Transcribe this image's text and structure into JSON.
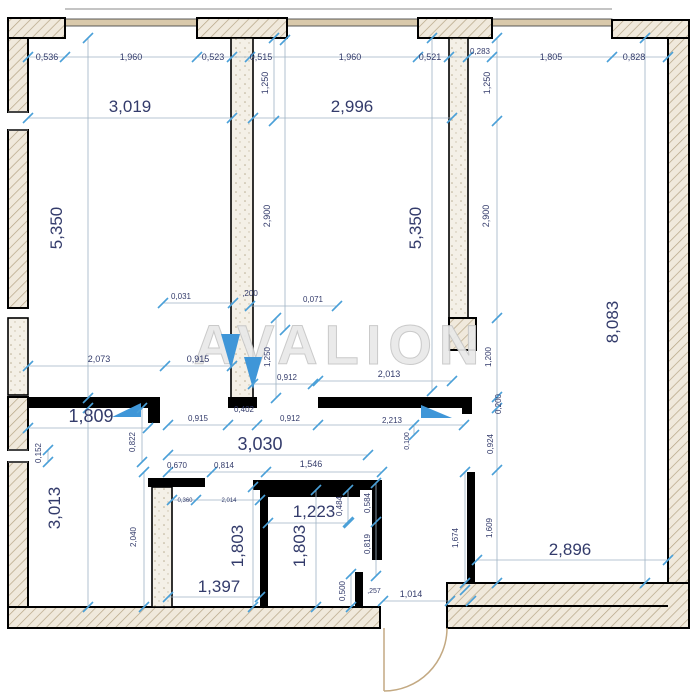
{
  "watermark": {
    "text": "AVALION"
  },
  "colors": {
    "wall": "#000000",
    "dimension_text": "#333b6b",
    "dimension_line": "#9fb3c4",
    "tick": "#4aa0d8",
    "door_swing_marker": "#3f96d8",
    "door_arc": "#c3a982",
    "watermark": "#e9e9e9",
    "window_band": "#d9c9ab",
    "hatch_fill": "#f0e9dc",
    "hatch_line": "#b5a484"
  },
  "dimensions": [
    {
      "t": "0,536",
      "x": 47,
      "y": 60,
      "r": 0,
      "s": 9
    },
    {
      "t": "1,960",
      "x": 131,
      "y": 60,
      "r": 0,
      "s": 9
    },
    {
      "t": "0,523",
      "x": 213,
      "y": 60,
      "r": 0,
      "s": 9
    },
    {
      "t": "0,515",
      "x": 261,
      "y": 60,
      "r": 0,
      "s": 9
    },
    {
      "t": "1,960",
      "x": 350,
      "y": 60,
      "r": 0,
      "s": 9
    },
    {
      "t": "0,521",
      "x": 430,
      "y": 60,
      "r": 0,
      "s": 9
    },
    {
      "t": "0,283",
      "x": 480,
      "y": 54,
      "r": 0,
      "s": 8
    },
    {
      "t": "1,805",
      "x": 551,
      "y": 60,
      "r": 0,
      "s": 9
    },
    {
      "t": "0,828",
      "x": 634,
      "y": 60,
      "r": 0,
      "s": 9
    },
    {
      "t": "3,019",
      "x": 130,
      "y": 112,
      "r": 0,
      "s": 17
    },
    {
      "t": "2,996",
      "x": 352,
      "y": 112,
      "r": 0,
      "s": 17
    },
    {
      "t": "1,250",
      "x": 268,
      "y": 83,
      "r": -90,
      "s": 9
    },
    {
      "t": "1,250",
      "x": 490,
      "y": 83,
      "r": -90,
      "s": 9
    },
    {
      "t": "5,350",
      "x": 62,
      "y": 228,
      "r": -90,
      "s": 17
    },
    {
      "t": "2,900",
      "x": 270,
      "y": 216,
      "r": -90,
      "s": 9
    },
    {
      "t": "5,350",
      "x": 421,
      "y": 228,
      "r": -90,
      "s": 17
    },
    {
      "t": "2,900",
      "x": 489,
      "y": 216,
      "r": -90,
      "s": 9
    },
    {
      "t": "8,083",
      "x": 618,
      "y": 322,
      "r": -90,
      "s": 17
    },
    {
      "t": "0,031",
      "x": 181,
      "y": 299,
      "r": 0,
      "s": 8
    },
    {
      "t": ",200",
      "x": 250,
      "y": 296,
      "r": 0,
      "s": 8
    },
    {
      "t": "0,071",
      "x": 313,
      "y": 302,
      "r": 0,
      "s": 8
    },
    {
      "t": "2,073",
      "x": 99,
      "y": 362,
      "r": 0,
      "s": 9
    },
    {
      "t": "0,915",
      "x": 198,
      "y": 362,
      "r": 0,
      "s": 9
    },
    {
      "t": "1,250",
      "x": 270,
      "y": 357,
      "r": -90,
      "s": 8
    },
    {
      "t": "0,912",
      "x": 287,
      "y": 380,
      "r": 0,
      "s": 8
    },
    {
      "t": "2,013",
      "x": 389,
      "y": 377,
      "r": 0,
      "s": 9
    },
    {
      "t": "1,200",
      "x": 491,
      "y": 357,
      "r": -90,
      "s": 8
    },
    {
      "t": "1,809",
      "x": 91,
      "y": 422,
      "r": 0,
      "s": 18
    },
    {
      "t": "0,915",
      "x": 198,
      "y": 421,
      "r": 0,
      "s": 8
    },
    {
      "t": "0,912",
      "x": 290,
      "y": 421,
      "r": 0,
      "s": 8
    },
    {
      "t": "0,402",
      "x": 244,
      "y": 412,
      "r": 0,
      "s": 8
    },
    {
      "t": "2,213",
      "x": 392,
      "y": 423,
      "r": 0,
      "s": 8
    },
    {
      "t": "0,100",
      "x": 409,
      "y": 441,
      "r": -90,
      "s": 7
    },
    {
      "t": "0,200",
      "x": 501,
      "y": 404,
      "r": -90,
      "s": 8
    },
    {
      "t": "0,924",
      "x": 493,
      "y": 444,
      "r": -90,
      "s": 8
    },
    {
      "t": "0,152",
      "x": 41,
      "y": 453,
      "r": -90,
      "s": 8
    },
    {
      "t": "0,822",
      "x": 135,
      "y": 442,
      "r": -90,
      "s": 8
    },
    {
      "t": "3,030",
      "x": 260,
      "y": 450,
      "r": 0,
      "s": 18
    },
    {
      "t": "0,670",
      "x": 177,
      "y": 468,
      "r": 0,
      "s": 8
    },
    {
      "t": "0,814",
      "x": 224,
      "y": 468,
      "r": 0,
      "s": 8
    },
    {
      "t": "1,546",
      "x": 311,
      "y": 467,
      "r": 0,
      "s": 9
    },
    {
      "t": "3,013",
      "x": 60,
      "y": 508,
      "r": -90,
      "s": 17
    },
    {
      "t": "2,040",
      "x": 136,
      "y": 537,
      "r": -90,
      "s": 8
    },
    {
      "t": "0,360",
      "x": 185,
      "y": 502,
      "r": 0,
      "s": 6
    },
    {
      "t": "2,014",
      "x": 229,
      "y": 502,
      "r": 0,
      "s": 6
    },
    {
      "t": "1,223",
      "x": 314,
      "y": 517,
      "r": 0,
      "s": 17
    },
    {
      "t": "1,803",
      "x": 243,
      "y": 546,
      "r": -90,
      "s": 17
    },
    {
      "t": "1,803",
      "x": 305,
      "y": 546,
      "r": -90,
      "s": 17
    },
    {
      "t": "0,484",
      "x": 342,
      "y": 506,
      "r": -90,
      "s": 8
    },
    {
      "t": "0,584",
      "x": 370,
      "y": 503,
      "r": -90,
      "s": 8
    },
    {
      "t": "0,819",
      "x": 370,
      "y": 544,
      "r": -90,
      "s": 8
    },
    {
      "t": "0,500",
      "x": 345,
      "y": 591,
      "r": -90,
      "s": 8
    },
    {
      "t": ",257",
      "x": 374,
      "y": 593,
      "r": 0,
      "s": 7
    },
    {
      "t": "1,674",
      "x": 458,
      "y": 538,
      "r": -90,
      "s": 8
    },
    {
      "t": "1,609",
      "x": 492,
      "y": 528,
      "r": -90,
      "s": 8
    },
    {
      "t": "1,397",
      "x": 219,
      "y": 592,
      "r": 0,
      "s": 17
    },
    {
      "t": "1,014",
      "x": 411,
      "y": 597,
      "r": 0,
      "s": 9
    },
    {
      "t": "2,896",
      "x": 570,
      "y": 555,
      "r": 0,
      "s": 17
    }
  ]
}
